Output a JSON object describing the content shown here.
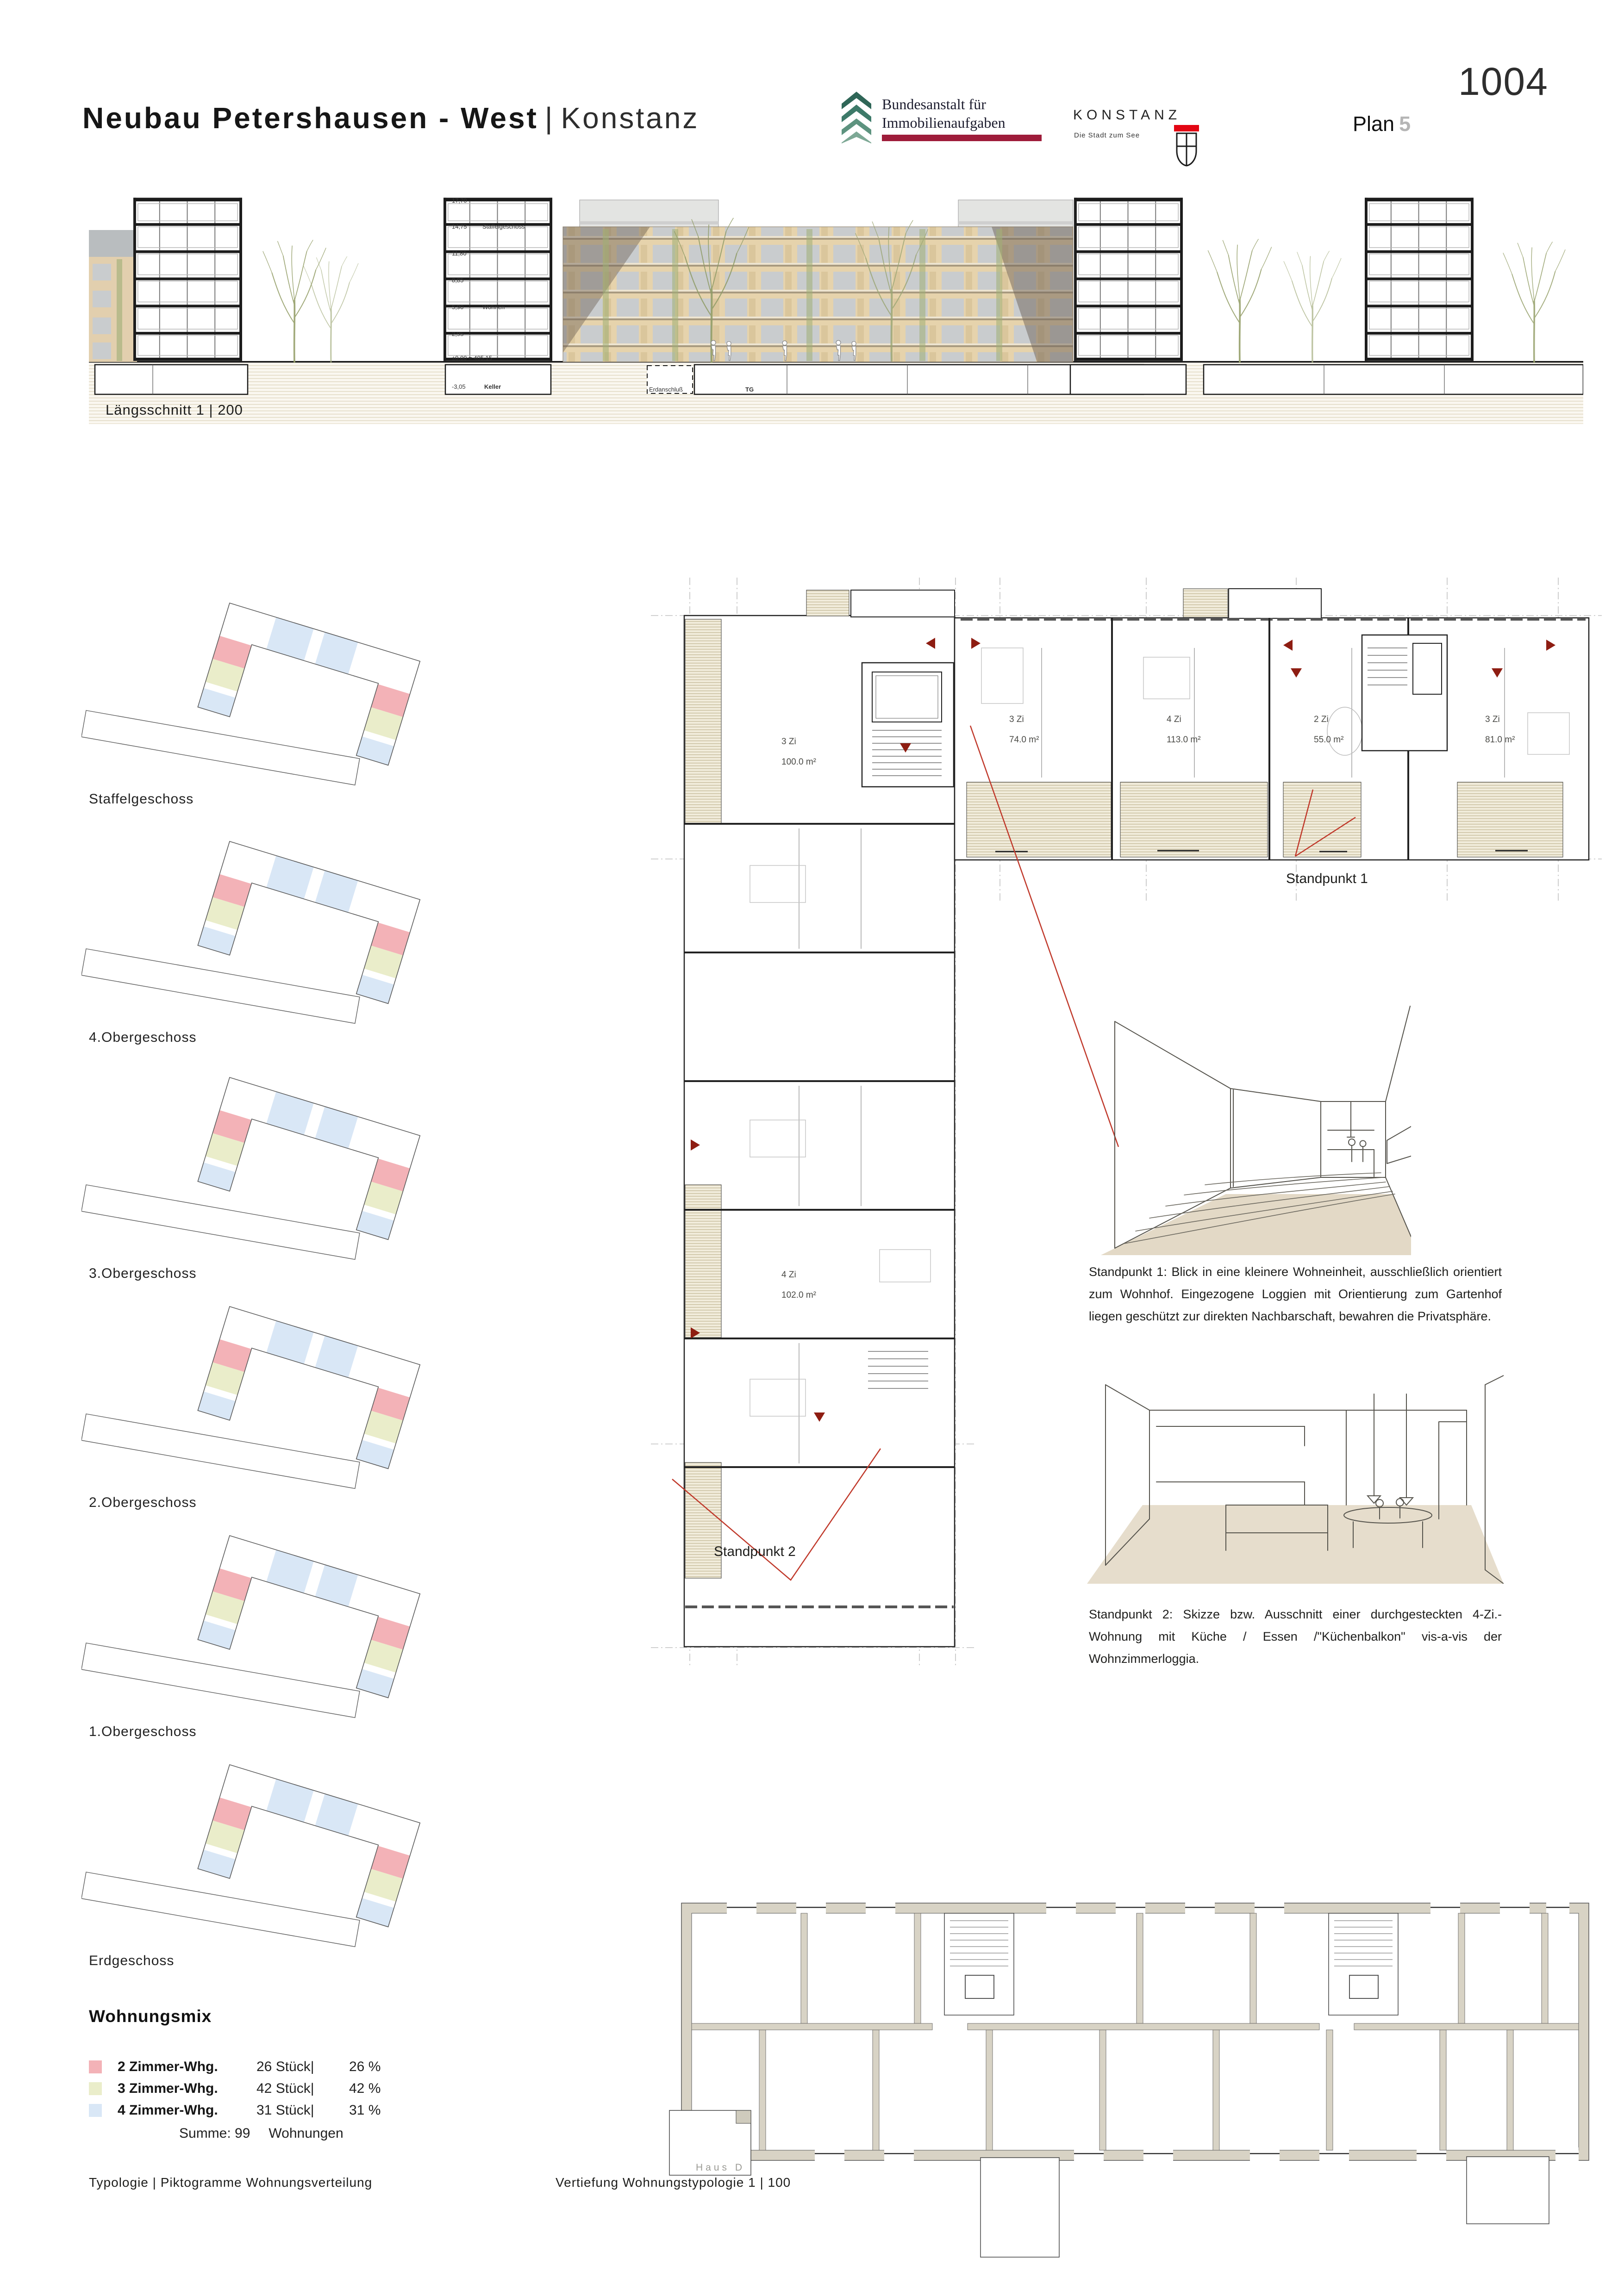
{
  "page": {
    "competition_code": "1004",
    "plan_word": "Plan",
    "plan_number": "5"
  },
  "header": {
    "title_main": "Neubau Petershausen - West",
    "title_sep": "|",
    "title_city": "Konstanz",
    "bima": {
      "line1": "Bundesanstalt für",
      "line2": "Immobilienaufgaben"
    },
    "konstanz": {
      "wordmark": "KONSTANZ",
      "tagline": "Die Stadt zum See"
    }
  },
  "section": {
    "label": "Längsschnitt 1 | 200",
    "levels": [
      "17,70",
      "14,75",
      "11,80",
      "8,85",
      "5,90",
      "2,95",
      "±0,00 = 405,15",
      "-3,05"
    ],
    "note_staffel": "Staffelgeschoss",
    "note_wohnen": "Wohnen",
    "note_keller": "Keller",
    "note_erdanschluss": "Erdanschluß",
    "note_tg": "TG"
  },
  "floors": [
    {
      "label": "Staffelgeschoss"
    },
    {
      "label": "4.Obergeschoss"
    },
    {
      "label": "3.Obergeschoss"
    },
    {
      "label": "2.Obergeschoss"
    },
    {
      "label": "1.Obergeschoss"
    },
    {
      "label": "Erdgeschoss"
    }
  ],
  "wohnungsmix": {
    "title": "Wohnungsmix",
    "rows": [
      {
        "label": "2 Zimmer-Whg.",
        "count": "26 Stück|",
        "percent": "26 %"
      },
      {
        "label": "3 Zimmer-Whg.",
        "count": "42 Stück|",
        "percent": "42 %"
      },
      {
        "label": "4 Zimmer-Whg.",
        "count": "31 Stück|",
        "percent": "31 %"
      }
    ],
    "sum_label": "Summe: 99",
    "sum_unit": "Wohnungen"
  },
  "plan_detail": {
    "units": [
      {
        "rooms": "3 Zi",
        "area": "100.0 m²"
      },
      {
        "rooms": "4 Zi",
        "area": "102.0 m²"
      },
      {
        "rooms": "3 Zi",
        "area": "74.0 m²"
      },
      {
        "rooms": "4 Zi",
        "area": "113.0 m²"
      },
      {
        "rooms": "2 Zi",
        "area": "55.0 m²"
      },
      {
        "rooms": "3 Zi",
        "area": "81.0 m²"
      }
    ],
    "standpunkt1_label": "Standpunkt 1",
    "standpunkt2_label": "Standpunkt 2",
    "haus_label": "Haus D"
  },
  "captions": {
    "standpunkt1": "Standpunkt 1: Blick in eine kleinere Wohneinheit, ausschließlich orientiert zum Wohnhof. Eingezogene Loggien mit Orientierung zum Gartenhof liegen geschützt zur direkten Nachbarschaft, bewahren die Privatsphäre.",
    "standpunkt2": "Standpunkt 2: Skizze bzw. Ausschnitt einer durchgesteckten 4-Zi.-Wohnung mit Küche / Essen /\"Küchenbalkon\" vis-a-vis der Wohnzimmerloggia."
  },
  "footer": {
    "left": "Typologie | Piktogramme Wohnungsverteilung",
    "right": "Vertiefung Wohnungstypologie 1 | 100"
  },
  "colors": {
    "mix_2zi": "#f3b2b7",
    "mix_3zi": "#eaedca",
    "mix_4zi": "#d9e7f6",
    "accent_red": "#8e1d12",
    "leader_red": "#c0392b",
    "bima_green": "#2f6657",
    "bima_red": "#9e1c3a",
    "konstanz_red": "#e30613",
    "hatch_beige": "#f1ecdb",
    "poche_grey": "#d8d3c5"
  }
}
